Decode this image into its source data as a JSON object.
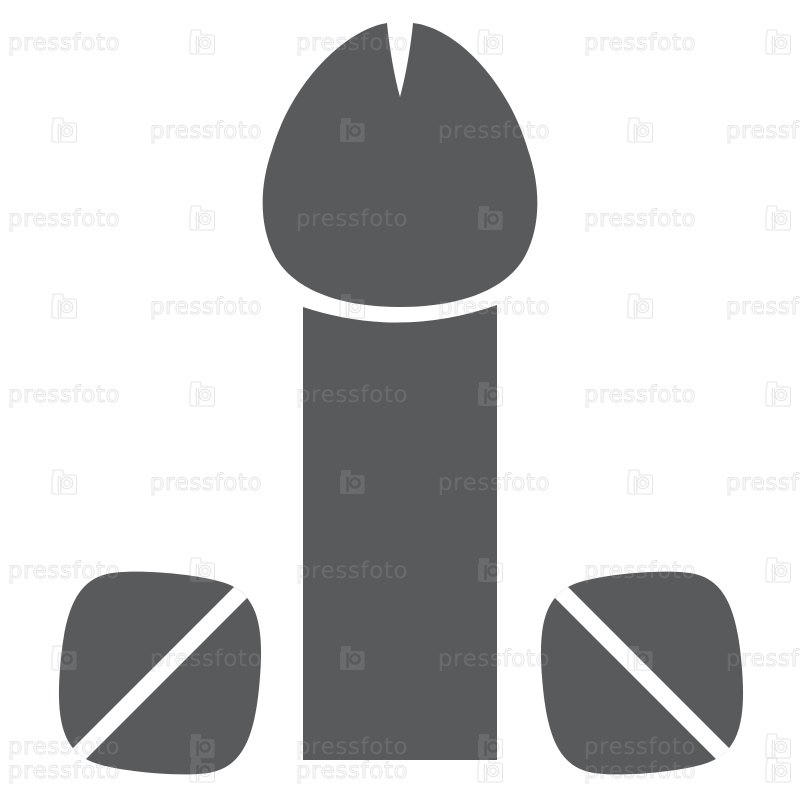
{
  "page": {
    "background_color": "#ffffff"
  },
  "icon": {
    "color": "#595a5c",
    "detail_white": "#ffffff"
  },
  "watermark": {
    "text": "pressfoto",
    "logo": "pressfoto camera logo",
    "outline_color_on_white": "#e9e9ec",
    "tint_color_on_gray": "#6a6b6d"
  }
}
